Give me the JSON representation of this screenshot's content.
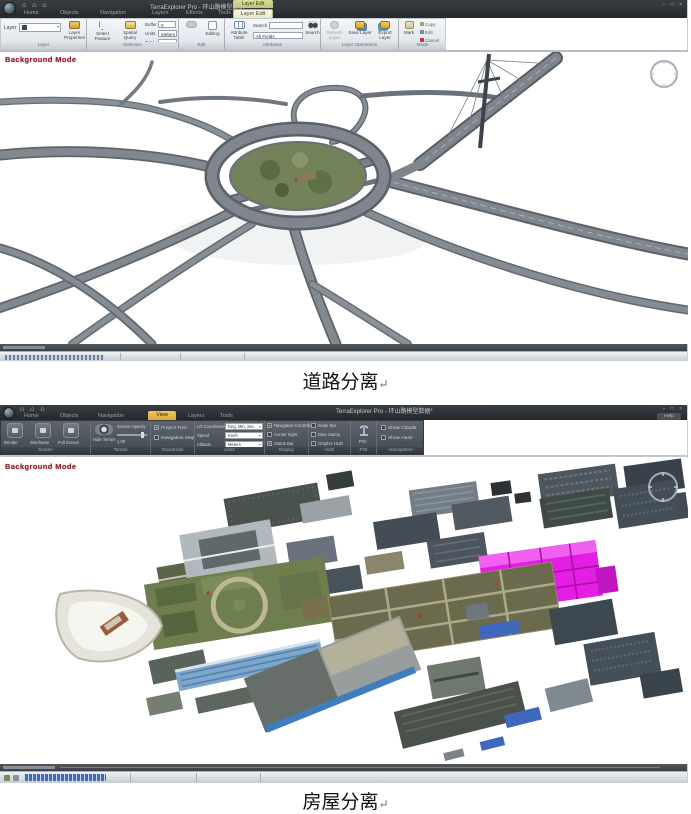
{
  "captions": {
    "road": "道路分离",
    "house": "房屋分离",
    "return_mark": "↵"
  },
  "colors": {
    "selection_magenta": "#e41ee4",
    "background_mode_red": "#8e1c2e",
    "contextual_tab_yellow": "#d9dc9a",
    "active_tab_orange": "#e8b84d"
  },
  "s1": {
    "title": "TerraExplorer Pro - 环山路模型数据*",
    "tabs": [
      "Home",
      "Objects",
      "Navigation",
      "Layers",
      "Effects",
      "Tools"
    ],
    "contextual_group": "Layer Edit",
    "active_tab": "Layer Edit",
    "window": {
      "minimize": "–",
      "maximize": "□",
      "close": "×"
    },
    "background_mode": "Background Mode",
    "ribbon": {
      "layer_label": "Layer",
      "layer_properties": "Layer Properties",
      "select_feature": "Select Feature",
      "spatial_query": "Spatial Query",
      "buffer_label": "Buffer",
      "buffer_value": "0",
      "units_label": "Units",
      "units_value": "Meters",
      "type_label": "Type",
      "type_value": "Intersect",
      "editing": "Editing",
      "attribute_table": "Attribute Table",
      "search_label": "Search",
      "search_scope": "All Fields",
      "search_button": "Search",
      "refresh_layer": "Refresh Layer",
      "save_layer": "Save Layer",
      "export_layer": "Export Layer",
      "mark": "Mark",
      "mini_items": [
        "Copy",
        "Edit",
        "Cancel"
      ],
      "group_captions": [
        "Layer",
        "Selection",
        "Edit",
        "Attributes",
        "Layer Operations",
        "Mode"
      ]
    }
  },
  "s2": {
    "title": "TerraExplorer Pro - 环山路模型数据*",
    "tabs": [
      "Home",
      "Objects",
      "Navigation",
      "View",
      "Layers",
      "Tools"
    ],
    "active_tab": "View",
    "help": "Help",
    "window": {
      "minimize": "–",
      "maximize": "□",
      "close": "×"
    },
    "background_mode": "Background Mode",
    "ribbon": {
      "screen_buttons": [
        "Render",
        "Wireframe",
        "Full Screen"
      ],
      "hide_terrain": "Hide Terrain",
      "screen_opacity_label": "Screen Opacity",
      "opacity_value": "1,00",
      "checks_a": [
        "Project Tree",
        "Navigation Map"
      ],
      "unit_rows": [
        {
          "label": "LR Coordinates",
          "value": "Deg, Min, Sec"
        },
        {
          "label": "Speed",
          "value": "Km/h"
        },
        {
          "label": "Altitude",
          "value": "Meters"
        }
      ],
      "checks_b": [
        "Navigation Controls",
        "Center Sight",
        "Status Bar"
      ],
      "checks_c": [
        "Scale Bar",
        "Date Stamp",
        "Graphic HUD"
      ],
      "poi": "POI",
      "checks_d": [
        "Show Clouds",
        "Show Haze"
      ],
      "group_captions": [
        "Screen",
        "Terrain",
        "Show/Hide",
        "Units",
        "Display",
        "HUD",
        "POI",
        "Atmosphere"
      ]
    }
  }
}
